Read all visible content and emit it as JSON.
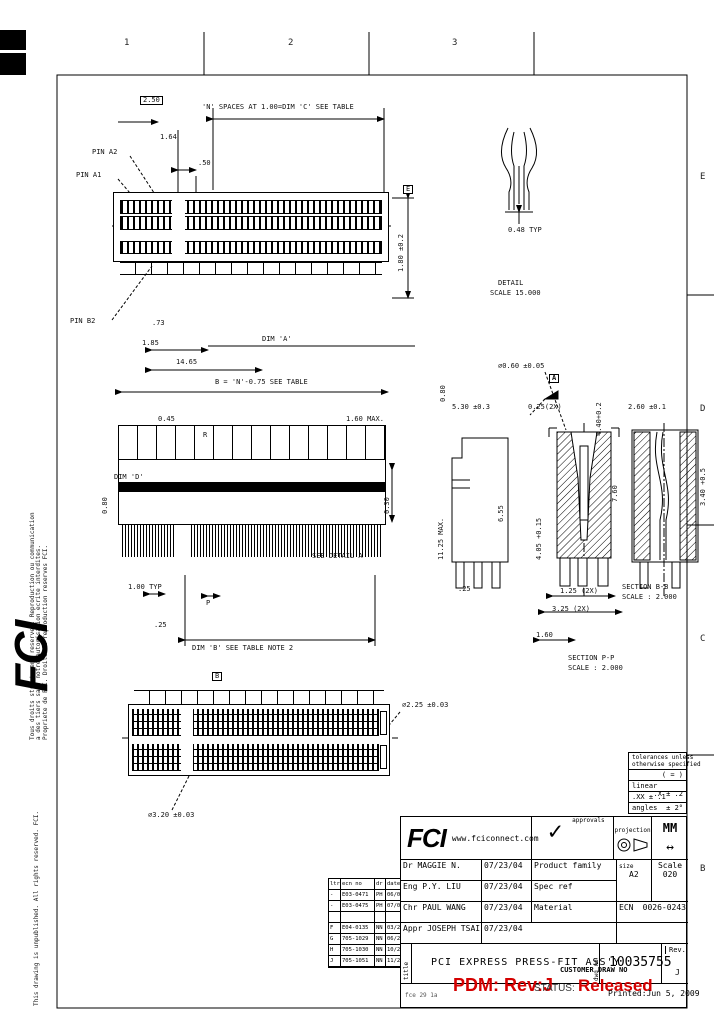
{
  "zones": {
    "top1": "1",
    "top2": "2",
    "top3": "3",
    "r1": "E",
    "r2": "D",
    "r3": "C",
    "r4": "B"
  },
  "margins": {
    "fr1": "Tous droits strictement reserves. Reproduction ou communication",
    "fr2": "a des tiers sans notre autorisation ecrite interdites.",
    "fr3": "Propriete de FCI. Droits de reproduction reserves FCI.",
    "en1": "This drawing is unpublished. All rights reserved. FCI.",
    "logo": "FCI"
  },
  "detail": {
    "dim": "0.48 TYP",
    "name": "DETAIL",
    "scale": "SCALE 15.000"
  },
  "markers": {
    "a": "A",
    "b": "B",
    "e": "E"
  },
  "sections": {
    "bb": "SECTION B-B",
    "bb_scale": "SCALE : 2.000",
    "pp": "SECTION P-P",
    "pp_scale": "SCALE : 2.000"
  },
  "dims": {
    "box250": "2.50",
    "nspaces": "'N' SPACES AT 1.00=DIM 'C' SEE TABLE",
    "v164": "1.64",
    "v50": ".50",
    "pinA2": "PIN A2",
    "pinA1": "PIN A1",
    "pinB2": "PIN B2",
    "v73": ".73",
    "v185": "1.85",
    "v1465": "14.65",
    "dimA": "DIM 'A'",
    "v180": "1.80 ±0.2",
    "beq": "B = 'N'-0.75 SEE TABLE",
    "v045": "0.45",
    "v160max": "1.60 MAX.",
    "rlab": "R",
    "plab": "P",
    "dimD": "DIM 'D'",
    "v080a": "0.80",
    "v080b": "0.80",
    "v030": "0.30",
    "seedetail": "SEE DETAIL A",
    "v100typ": "1.00 TYP",
    "v25a": ".25",
    "dimB": "DIM 'B' SEE TABLE NOTE 2",
    "r060": "⌀0.60 ±0.05",
    "v530": "5.30 ±0.3",
    "v025x": "0.25(2X)",
    "v260": "2.60 ±0.1",
    "v1125": "11.25 MAX.",
    "v655": "6.55",
    "v440": "4.40+0.2",
    "v760": "7.60",
    "v340": "3.40 +0.5",
    "v405": "4.05 +0.15",
    "v125x": "1.25 (2X)",
    "v325x": "3.25 (2X)",
    "v160b": "1.60",
    "v25b": ".25",
    "d225": "⌀2.25 ±0.03",
    "d320": "⌀3.20 ±0.03"
  },
  "tolerance": {
    "h1": "tolerances unless",
    "h2": "otherwise specified",
    "eq": "( = )",
    "linear": "linear",
    "lin1": ".X ± .2",
    "lin2": ".XX ± .1",
    "ang_label": "angles",
    "ang": "± 2°"
  },
  "revisions": {
    "headers": [
      "ltr",
      "ecn no",
      "dr",
      "date"
    ],
    "rows": [
      [
        "-",
        "E03-0471",
        "PH",
        "06/03"
      ],
      [
        "-",
        "E03-0475",
        "PH",
        "07/03"
      ],
      [
        "",
        "",
        "",
        ""
      ],
      [
        "F",
        "E04-0135",
        "NN",
        "03/2005"
      ],
      [
        "G",
        "705-1029",
        "NN",
        "06/2005"
      ],
      [
        "H",
        "705-1030",
        "NN",
        "10/2005"
      ],
      [
        "J",
        "705-1051",
        "NN",
        "11/2005"
      ]
    ]
  },
  "title_block": {
    "logo": "FCI",
    "website": "www.fciconnect.com",
    "approvals": "approvals",
    "approvals_check": "✓",
    "projection": "projection",
    "units": "MM",
    "units_arrow": "↔",
    "r1_role": "Dr",
    "r1_name": "MAGGIE N.",
    "r1_date": "07/23/04",
    "r1_field": "Product family",
    "r2_role": "Eng",
    "r2_name": "P.Y. LIU",
    "r2_date": "07/23/04",
    "r2_field": "Spec ref",
    "r3_role": "Chr",
    "r3_name": "PAUL WANG",
    "r3_date": "07/23/04",
    "r3_field": "Material",
    "r4_role": "Appr",
    "r4_name": "JOSEPH TSAI",
    "r4_date": "07/23/04",
    "size_label": "size",
    "size": "A2",
    "scale_label": "Scale",
    "scale": "020",
    "ecn_label": "ECN",
    "ecn_no": "0026-0243",
    "title_label": "title",
    "dwg_label": "dwg no",
    "title": "PCI EXPRESS PRESS-FIT ASS'Y",
    "number": "10035755",
    "rev_label": "Rev.",
    "rev": "J",
    "form": "fce 29 1a"
  },
  "stamps": {
    "pdm": "PDM: Rev:J",
    "status_label": "STATUS:",
    "status": "Released",
    "customer": "CUSTOMER DRAW NO",
    "printed": "Printed:Jun  5, 2009"
  }
}
